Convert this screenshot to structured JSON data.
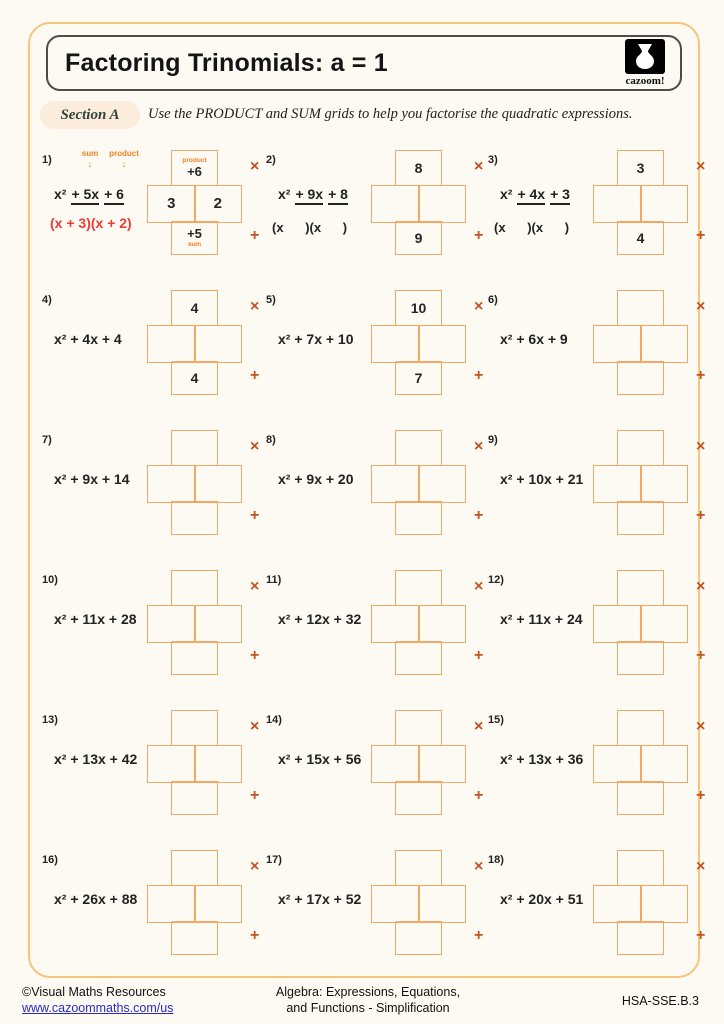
{
  "header": {
    "title": "Factoring Trinomials: a = 1",
    "logo_text": "cazoom!"
  },
  "section": {
    "label": "Section A",
    "instruction": "Use the PRODUCT and SUM grids to help you factorise the quadratic expressions."
  },
  "glyphs": {
    "arrow_down": "↓",
    "multiply": "×",
    "add": "+"
  },
  "colors": {
    "outer_border": "#f6c57c",
    "grid_border": "#f3a765",
    "symbol_rust": "#c4531f",
    "annotation_orange": "#f08123",
    "answer_red": "#ee3a36",
    "section_pill_bg": "#fcecdc",
    "link_blue": "#2a2ac4"
  },
  "problems": [
    {
      "n": "1)",
      "terms": [
        {
          "t": "x²",
          "u": false
        },
        {
          "t": "+ 5x",
          "u": true
        },
        {
          "t": "+ 6",
          "u": true
        }
      ],
      "annotations": [
        "sum",
        "product"
      ],
      "answer": "(x + 3)(x + 2)",
      "product": "+6",
      "sum": "+5",
      "mid": [
        "3",
        "2"
      ],
      "grid_labels": {
        "top": "product",
        "bottom": "sum"
      }
    },
    {
      "n": "2)",
      "terms": [
        {
          "t": "x²",
          "u": false
        },
        {
          "t": "+ 9x",
          "u": true
        },
        {
          "t": "+ 8",
          "u": true
        }
      ],
      "hint": "(x      )(x      )",
      "product": "8",
      "sum": "9",
      "mid": [
        "",
        ""
      ]
    },
    {
      "n": "3)",
      "terms": [
        {
          "t": "x²",
          "u": false
        },
        {
          "t": "+ 4x",
          "u": true
        },
        {
          "t": "+ 3",
          "u": true
        }
      ],
      "hint": "(x      )(x      )",
      "product": "3",
      "sum": "4",
      "mid": [
        "",
        ""
      ]
    },
    {
      "n": "4)",
      "terms": [
        {
          "t": "x² + 4x + 4",
          "u": false
        }
      ],
      "product": "4",
      "sum": "4",
      "mid": [
        "",
        ""
      ]
    },
    {
      "n": "5)",
      "terms": [
        {
          "t": "x² + 7x + 10",
          "u": false
        }
      ],
      "product": "10",
      "sum": "7",
      "mid": [
        "",
        ""
      ]
    },
    {
      "n": "6)",
      "terms": [
        {
          "t": "x² + 6x + 9",
          "u": false
        }
      ],
      "product": "",
      "sum": "",
      "mid": [
        "",
        ""
      ]
    },
    {
      "n": "7)",
      "terms": [
        {
          "t": "x² + 9x + 14",
          "u": false
        }
      ],
      "product": "",
      "sum": "",
      "mid": [
        "",
        ""
      ]
    },
    {
      "n": "8)",
      "terms": [
        {
          "t": "x² + 9x + 20",
          "u": false
        }
      ],
      "product": "",
      "sum": "",
      "mid": [
        "",
        ""
      ]
    },
    {
      "n": "9)",
      "terms": [
        {
          "t": "x² + 10x + 21",
          "u": false
        }
      ],
      "product": "",
      "sum": "",
      "mid": [
        "",
        ""
      ]
    },
    {
      "n": "10)",
      "terms": [
        {
          "t": "x² + 11x + 28",
          "u": false
        }
      ],
      "product": "",
      "sum": "",
      "mid": [
        "",
        ""
      ]
    },
    {
      "n": "11)",
      "terms": [
        {
          "t": "x² + 12x + 32",
          "u": false
        }
      ],
      "product": "",
      "sum": "",
      "mid": [
        "",
        ""
      ]
    },
    {
      "n": "12)",
      "terms": [
        {
          "t": "x² + 11x + 24",
          "u": false
        }
      ],
      "product": "",
      "sum": "",
      "mid": [
        "",
        ""
      ]
    },
    {
      "n": "13)",
      "terms": [
        {
          "t": "x² + 13x + 42",
          "u": false
        }
      ],
      "product": "",
      "sum": "",
      "mid": [
        "",
        ""
      ]
    },
    {
      "n": "14)",
      "terms": [
        {
          "t": "x² + 15x + 56",
          "u": false
        }
      ],
      "product": "",
      "sum": "",
      "mid": [
        "",
        ""
      ]
    },
    {
      "n": "15)",
      "terms": [
        {
          "t": "x² + 13x + 36",
          "u": false
        }
      ],
      "product": "",
      "sum": "",
      "mid": [
        "",
        ""
      ]
    },
    {
      "n": "16)",
      "terms": [
        {
          "t": "x² + 26x + 88",
          "u": false
        }
      ],
      "product": "",
      "sum": "",
      "mid": [
        "",
        ""
      ]
    },
    {
      "n": "17)",
      "terms": [
        {
          "t": "x² + 17x + 52",
          "u": false
        }
      ],
      "product": "",
      "sum": "",
      "mid": [
        "",
        ""
      ]
    },
    {
      "n": "18)",
      "terms": [
        {
          "t": "x² + 20x + 51",
          "u": false
        }
      ],
      "product": "",
      "sum": "",
      "mid": [
        "",
        ""
      ]
    }
  ],
  "footer": {
    "copyright": "©Visual Maths Resources",
    "url": "www.cazoommaths.com/us",
    "center_line1": "Algebra: Expressions, Equations,",
    "center_line2": "and Functions - Simplification",
    "code": "HSA-SSE.B.3"
  }
}
